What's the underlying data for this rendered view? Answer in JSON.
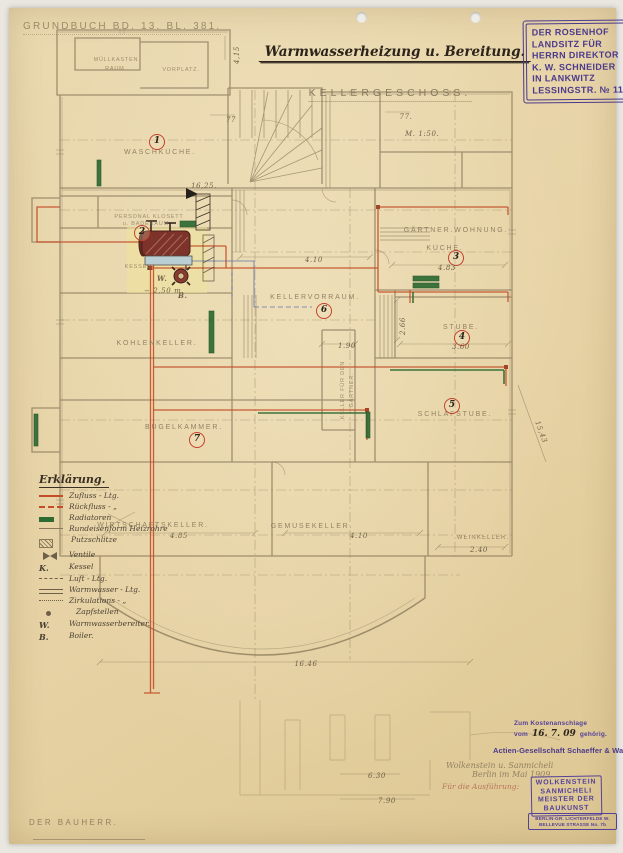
{
  "header": {
    "grundbuch_note": "GRUNDBUCH BD. 13. BL. 381.",
    "title": "Warmwasserheizung u. Bereitung.",
    "floor_label": "KELLERGESCHOSS.",
    "scale_note": "M. 1:50."
  },
  "estate_stamp": {
    "lines": [
      "DER ROSENHOF",
      "LANDSITZ FÜR",
      "HERRN DIREKTOR",
      "K. W. SCHNEIDER",
      "IN LANKWITZ",
      "LESSINGSTR. № 11"
    ]
  },
  "rooms": [
    {
      "label": "MÜLLKASTEN",
      "label2": "RAUM."
    },
    {
      "label": "VORPLATZ."
    },
    {
      "label": "WASCHKÜCHE.",
      "num": "1"
    },
    {
      "label": "PERSONAL KLOSETT",
      "label2": "u. BADERAUM.",
      "num": "2"
    },
    {
      "label": "KESSEL."
    },
    {
      "label": "KELLERVORRAUM.",
      "num": "6"
    },
    {
      "label": "GÄRTNER.WOHNUNG."
    },
    {
      "label": "KÜCHE.",
      "num": "3"
    },
    {
      "label": "STUBE.",
      "num": "4"
    },
    {
      "label": "SCHLAFSTUBE.",
      "num": "5"
    },
    {
      "label": "KOHLENKELLER."
    },
    {
      "label": "BÜGELKAMMER.",
      "num": "7"
    },
    {
      "label": "WIRTSCHAFTSKELLER."
    },
    {
      "label": "GEMÜSEKELLER."
    },
    {
      "label": "WEINKELLER."
    },
    {
      "label": "KELLER FÜR DEN",
      "label2": "GÄRTNER."
    }
  ],
  "dims": {
    "kueche": "4.83",
    "stube_w": "3.60",
    "stube_h": "2.66",
    "vorraum": "4.10",
    "wirtschaft": "4.85",
    "gemuese": "4.10",
    "wein": "2.40",
    "gaertner_keller": "1.90",
    "level_1625": "16,25.",
    "boiler_depth": "− 2,50 m.",
    "d77a": "77",
    "d77b": "77.",
    "d415": "4,15",
    "d1543": "15,43",
    "d1646": "16.46",
    "d630": "6.30",
    "d790": "7.90"
  },
  "boiler": {
    "heater_label": "W.",
    "boiler_label": "B."
  },
  "legend": {
    "title": "Erklärung.",
    "entries": [
      {
        "symbol": "line-red",
        "text": "Zufluss - Ltg."
      },
      {
        "symbol": "line-red-dash",
        "text": "Rückfluss - „"
      },
      {
        "symbol": "bar-green",
        "text": "Radiatoren"
      },
      {
        "symbol": "line-thin",
        "text": "Rundeisenform Heizrohre"
      },
      {
        "symbol": "box-hatch",
        "text": "Putzschlitze"
      },
      {
        "symbol": "valve",
        "text": "Ventile"
      },
      {
        "symbol": "letter",
        "k": "K.",
        "text": "Kessel"
      },
      {
        "symbol": "line-dash",
        "text": "Luft - Ltg."
      },
      {
        "symbol": "line-double",
        "text": "Warmwasser - Ltg."
      },
      {
        "symbol": "line-dashdot",
        "text": "Zirkulations - „"
      },
      {
        "symbol": "dot",
        "text": "Zapfstellen"
      },
      {
        "symbol": "letter",
        "k": "W.",
        "text": "Warmwasserbereiter."
      },
      {
        "symbol": "letter",
        "k": "B.",
        "text": "Boiler."
      }
    ]
  },
  "approval": {
    "kosten_stamp_line1": "Zum Kostenanschlage",
    "kosten_stamp_vom": "vom",
    "kosten_date": "16. 7. 09",
    "kosten_stamp_gehoerig": "gehörig.",
    "firm": "Actien-Gesellschaft Schaeffer & Walcker",
    "hand_line1": "Wolkenstein u. Sanmicheli",
    "hand_line2": "Berlin im Mai 1909.",
    "hand_red": "Für die Ausführung:",
    "architect_stamp": [
      "WOLKENSTEIN",
      "SANMICHELI",
      "MEISTER DER",
      "BAUKUNST"
    ],
    "address_stamp": [
      "BERLIN-GR. LICHTERFELDE W.",
      "BELLEVUE STRASSE No. 7b"
    ]
  },
  "footer": {
    "owner_label": "DER BAUHERR."
  },
  "colors": {
    "paper": "#e7d5a9",
    "pencil": "#8a7a5c",
    "ink": "#2c241a",
    "stamp_purple": "#4b3a8c",
    "pipe_red": "#c24d27",
    "radiator_green": "#2e6b33",
    "pipe_blue": "#6f81ab",
    "boiler_red": "#7e332a",
    "highlight_yellow": "#efe39b",
    "circle_red": "#c5402c"
  }
}
